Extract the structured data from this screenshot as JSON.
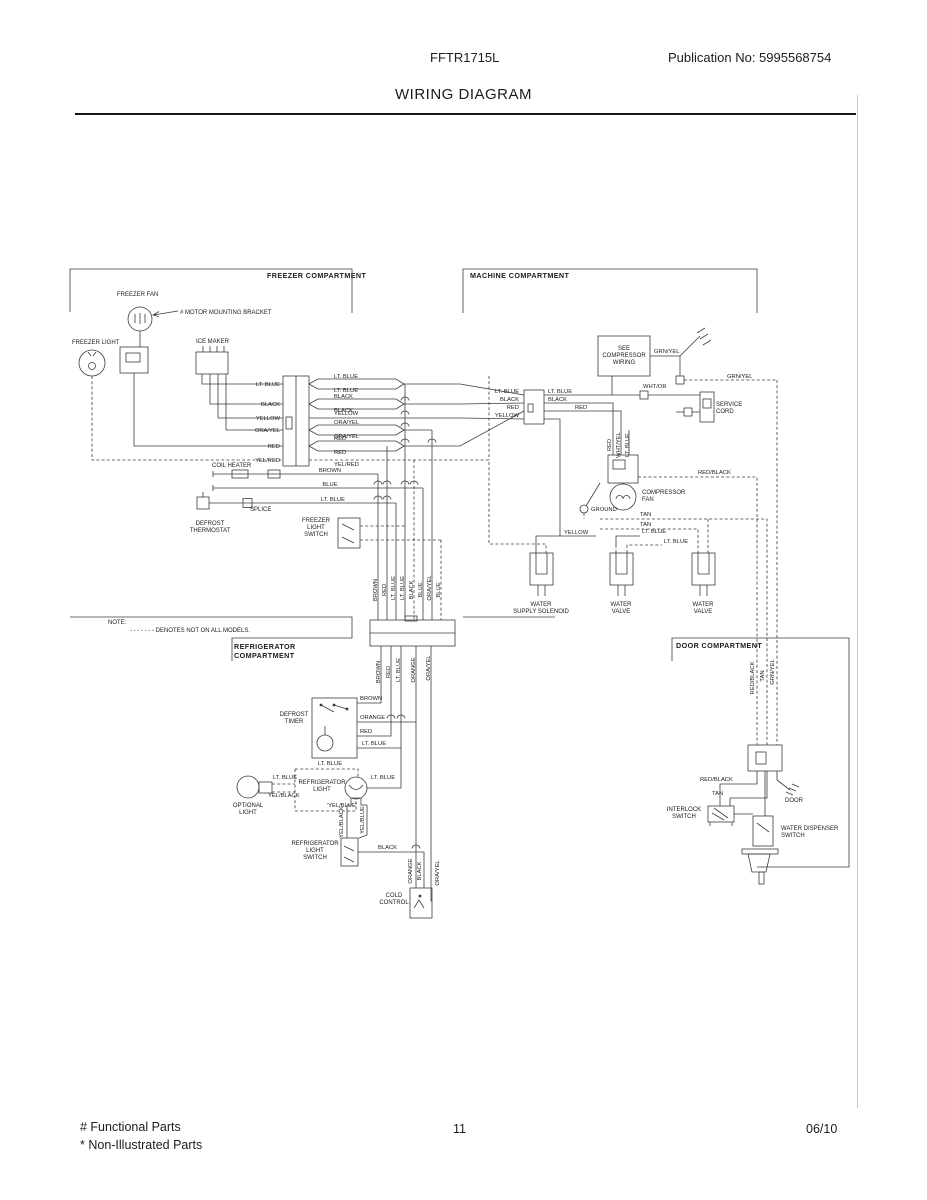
{
  "header": {
    "model": "FFTR1715L",
    "publication": "Publication No:  5995568754"
  },
  "title": "WIRING DIAGRAM",
  "footer": {
    "functional": "# Functional Parts",
    "non_illustrated": "* Non-Illustrated Parts",
    "page_number": "11",
    "date": "06/10"
  },
  "diagram": {
    "component_labels": [
      {
        "n": "freezer-compartment",
        "h": 1,
        "l": [
          "FREEZER COMPARTMENT"
        ],
        "x": 267,
        "y": 278
      },
      {
        "n": "machine-compartment",
        "h": 1,
        "l": [
          "MACHINE COMPARTMENT"
        ],
        "x": 470,
        "y": 278
      },
      {
        "n": "refrigerator-compartment",
        "h": 1,
        "l": [
          "REFRIGERATOR",
          "COMPARTMENT"
        ],
        "x": 234,
        "y": 649
      },
      {
        "n": "door-compartment",
        "h": 1,
        "l": [
          "DOOR COMPARTMENT"
        ],
        "x": 676,
        "y": 648
      },
      {
        "n": "freezer-fan",
        "l": [
          "FREEZER FAN"
        ],
        "x": 117,
        "y": 296
      },
      {
        "n": "motor-mounting-bracket",
        "l": [
          "# MOTOR MOUNTING BRACKET"
        ],
        "x": 180,
        "y": 314
      },
      {
        "n": "freezer-light",
        "l": [
          "FREEZER LIGHT"
        ],
        "x": 72,
        "y": 344
      },
      {
        "n": "ice-maker",
        "l": [
          "ICE MAKER"
        ],
        "x": 196,
        "y": 343
      },
      {
        "n": "coil-heater",
        "l": [
          "COIL HEATER"
        ],
        "x": 212,
        "y": 467
      },
      {
        "n": "splice",
        "l": [
          "SPLICE"
        ],
        "x": 250,
        "y": 511
      },
      {
        "n": "defrost-thermostat",
        "a": "m",
        "l": [
          "DEFROST",
          "THERMOSTAT"
        ],
        "x": 210,
        "y": 525
      },
      {
        "n": "freezer-light-switch",
        "a": "m",
        "l": [
          "FREEZER",
          "LIGHT",
          "SWITCH"
        ],
        "x": 316,
        "y": 522
      },
      {
        "n": "note-label",
        "l": [
          "NOTE:"
        ],
        "x": 108,
        "y": 624
      },
      {
        "n": "note-text",
        "l": [
          "- - - - - - -  DENOTES NOT ON ALL MODELS."
        ],
        "x": 130,
        "y": 632
      },
      {
        "n": "compressor-wiring-box",
        "a": "m",
        "l": [
          "SEE",
          "COMPRESSOR",
          "WIRING"
        ],
        "x": 624,
        "y": 350
      },
      {
        "n": "service-cord",
        "l": [
          "SERVICE",
          "CORD"
        ],
        "x": 716,
        "y": 406
      },
      {
        "n": "compressor-fan",
        "l": [
          "COMPRESSOR",
          "FAN"
        ],
        "x": 642,
        "y": 494
      },
      {
        "n": "water-supply-solenoid",
        "a": "m",
        "l": [
          "WATER",
          "SUPPLY SOLENOID"
        ],
        "x": 541,
        "y": 606
      },
      {
        "n": "water-valve-1",
        "a": "m",
        "l": [
          "WATER",
          "VALVE"
        ],
        "x": 621,
        "y": 606
      },
      {
        "n": "water-valve-2",
        "a": "m",
        "l": [
          "WATER",
          "VALVE"
        ],
        "x": 703,
        "y": 606
      },
      {
        "n": "defrost-timer",
        "a": "m",
        "l": [
          "DEFROST",
          "TIMER"
        ],
        "x": 294,
        "y": 716
      },
      {
        "n": "refrigerator-light",
        "a": "m",
        "l": [
          "REFRIGERATOR",
          "LIGHT"
        ],
        "x": 322,
        "y": 784
      },
      {
        "n": "optional-light",
        "a": "m",
        "l": [
          "OPTIONAL",
          "LIGHT"
        ],
        "x": 248,
        "y": 807
      },
      {
        "n": "refrigerator-light-switch",
        "a": "m",
        "l": [
          "REFRIGERATOR",
          "LIGHT",
          "SWITCH"
        ],
        "x": 315,
        "y": 845
      },
      {
        "n": "cold-control",
        "a": "m",
        "l": [
          "COLD",
          "CONTROL"
        ],
        "x": 394,
        "y": 897
      },
      {
        "n": "interlock-switch",
        "a": "m",
        "l": [
          "INTERLOCK",
          "SWITCH"
        ],
        "x": 684,
        "y": 811
      },
      {
        "n": "water-dispenser-switch",
        "l": [
          "WATER DISPENSER",
          "SWITCH"
        ],
        "x": 781,
        "y": 830
      },
      {
        "n": "door-ground",
        "l": [
          "DOOR"
        ],
        "x": 785,
        "y": 802
      }
    ],
    "wire_labels": [
      {
        "t": "LT. BLUE",
        "x": 280,
        "y": 386,
        "a": "e"
      },
      {
        "t": "BLACK",
        "x": 280,
        "y": 406,
        "a": "e"
      },
      {
        "t": "YELLOW",
        "x": 280,
        "y": 420,
        "a": "e"
      },
      {
        "t": "ORA/YEL",
        "x": 280,
        "y": 432,
        "a": "e"
      },
      {
        "t": "RED",
        "x": 280,
        "y": 448,
        "a": "e"
      },
      {
        "t": "YEL/RED",
        "x": 280,
        "y": 462,
        "a": "e"
      },
      {
        "t": "LT. BLUE",
        "x": 334,
        "y": 378
      },
      {
        "t": "LT. BLUE",
        "x": 334,
        "y": 392
      },
      {
        "t": "BLACK",
        "x": 334,
        "y": 398
      },
      {
        "t": "BLACK",
        "x": 334,
        "y": 412
      },
      {
        "t": "YELLOW",
        "x": 334,
        "y": 415
      },
      {
        "t": "ORA/YEL",
        "x": 334,
        "y": 424
      },
      {
        "t": "ORA/YEL",
        "x": 334,
        "y": 438
      },
      {
        "t": "RED",
        "x": 334,
        "y": 440
      },
      {
        "t": "RED",
        "x": 334,
        "y": 454
      },
      {
        "t": "YEL/RED",
        "x": 334,
        "y": 466
      },
      {
        "t": "BROWN",
        "x": 330,
        "y": 472,
        "a": "m"
      },
      {
        "t": "BLUE",
        "x": 330,
        "y": 486,
        "a": "m"
      },
      {
        "t": "LT. BLUE",
        "x": 333,
        "y": 501,
        "a": "m"
      },
      {
        "t": "LT. BLUE",
        "x": 519,
        "y": 393,
        "a": "e"
      },
      {
        "t": "BLACK",
        "x": 519,
        "y": 401,
        "a": "e"
      },
      {
        "t": "RED",
        "x": 519,
        "y": 409,
        "a": "e"
      },
      {
        "t": "YELLOW",
        "x": 519,
        "y": 417,
        "a": "e"
      },
      {
        "t": "LT. BLUE",
        "x": 548,
        "y": 393
      },
      {
        "t": "BLACK",
        "x": 548,
        "y": 401
      },
      {
        "t": "RED",
        "x": 575,
        "y": 409
      },
      {
        "t": "YELLOW",
        "x": 564,
        "y": 534
      },
      {
        "t": "WHT/OR",
        "x": 643,
        "y": 388
      },
      {
        "t": "GRN/YEL",
        "x": 654,
        "y": 353
      },
      {
        "t": "GRN/YEL",
        "x": 727,
        "y": 378
      },
      {
        "t": "RED/BLACK",
        "x": 698,
        "y": 474
      },
      {
        "t": "GROUND",
        "x": 591,
        "y": 511
      },
      {
        "t": "TAN",
        "x": 640,
        "y": 516
      },
      {
        "t": "TAN",
        "x": 640,
        "y": 526
      },
      {
        "t": "LT. BLUE",
        "x": 642,
        "y": 533
      },
      {
        "t": "LT. BLUE",
        "x": 664,
        "y": 543
      },
      {
        "t": "RED",
        "x": 611,
        "y": 445,
        "r": 1
      },
      {
        "t": "WHT/YEL",
        "x": 620,
        "y": 445,
        "r": 1
      },
      {
        "t": "LT. BLUE",
        "x": 629,
        "y": 445,
        "r": 1
      },
      {
        "t": "RED/BLACK",
        "x": 754,
        "y": 678,
        "r": 1
      },
      {
        "t": "TAN",
        "x": 764,
        "y": 676,
        "r": 1
      },
      {
        "t": "GRN/YEL",
        "x": 774,
        "y": 672,
        "r": 1
      },
      {
        "t": "RED/BLACK",
        "x": 700,
        "y": 781
      },
      {
        "t": "TAN",
        "x": 712,
        "y": 795
      },
      {
        "t": "BROWN",
        "x": 377,
        "y": 590,
        "r": 1
      },
      {
        "t": "RED",
        "x": 386,
        "y": 590,
        "r": 1
      },
      {
        "t": "LT. BLUE",
        "x": 395,
        "y": 588,
        "r": 1
      },
      {
        "t": "LT. BLUE",
        "x": 404,
        "y": 588,
        "r": 1
      },
      {
        "t": "BLACK",
        "x": 413,
        "y": 590,
        "r": 1
      },
      {
        "t": "BLUE",
        "x": 422,
        "y": 590,
        "r": 1
      },
      {
        "t": "ORA/YEL",
        "x": 431,
        "y": 588,
        "r": 1
      },
      {
        "t": "BLUE",
        "x": 440,
        "y": 590,
        "r": 1
      },
      {
        "t": "BROWN",
        "x": 380,
        "y": 672,
        "r": 1
      },
      {
        "t": "RED",
        "x": 390,
        "y": 672,
        "r": 1
      },
      {
        "t": "LT. BLUE",
        "x": 400,
        "y": 670,
        "r": 1
      },
      {
        "t": "ORANGE",
        "x": 415,
        "y": 670,
        "r": 1
      },
      {
        "t": "ORA/YEL",
        "x": 430,
        "y": 668,
        "r": 1
      },
      {
        "t": "BROWN",
        "x": 360,
        "y": 700
      },
      {
        "t": "ORANGE",
        "x": 360,
        "y": 719
      },
      {
        "t": "RED",
        "x": 360,
        "y": 733
      },
      {
        "t": "LT. BLUE",
        "x": 362,
        "y": 745
      },
      {
        "t": "LT. BLUE",
        "x": 318,
        "y": 765
      },
      {
        "t": "LT. BLUE",
        "x": 371,
        "y": 779
      },
      {
        "t": "LT. BLUE",
        "x": 273,
        "y": 779
      },
      {
        "t": "YEL/BLACK",
        "x": 268,
        "y": 797
      },
      {
        "t": "'YEL/BLUE'",
        "x": 327,
        "y": 807
      },
      {
        "t": "YEL/BLACK",
        "x": 343,
        "y": 822,
        "r": 1
      },
      {
        "t": "YEL/BLUE",
        "x": 364,
        "y": 820,
        "r": 1
      },
      {
        "t": "BLACK",
        "x": 378,
        "y": 849
      },
      {
        "t": "ORANGE",
        "x": 412,
        "y": 871,
        "r": 1
      },
      {
        "t": "BLACK",
        "x": 421,
        "y": 871,
        "r": 1
      },
      {
        "t": "ORA/YEL",
        "x": 439,
        "y": 873,
        "r": 1
      }
    ]
  }
}
